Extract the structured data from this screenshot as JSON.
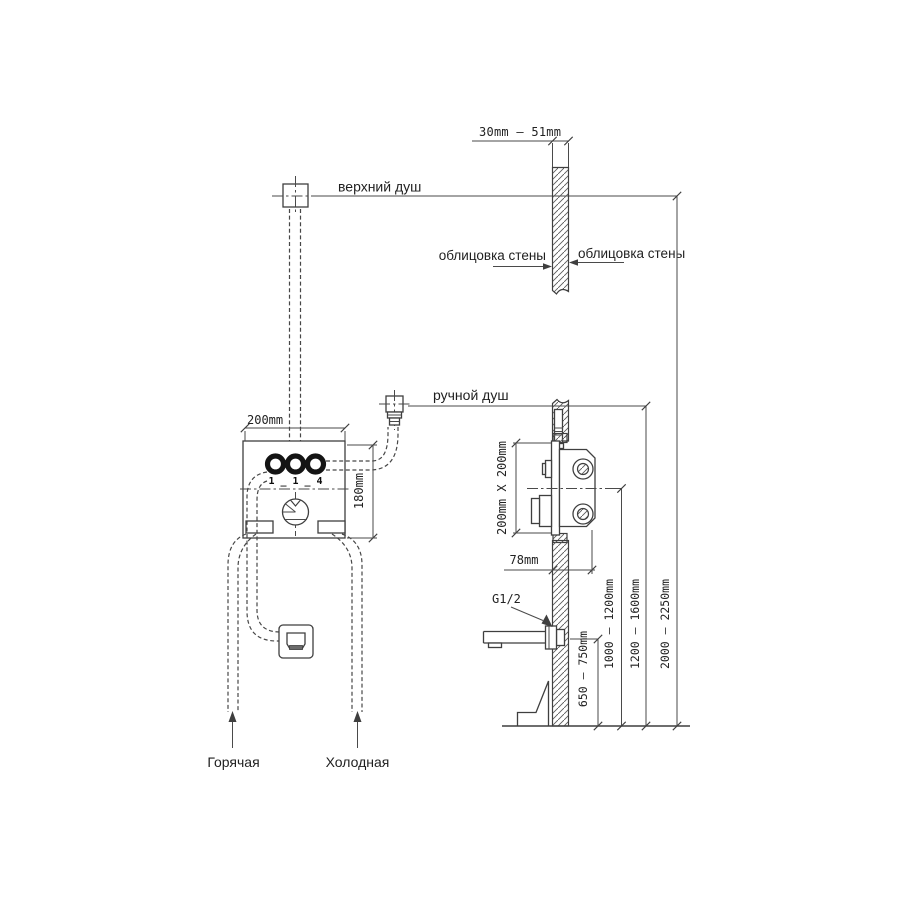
{
  "labels": {
    "top_thickness": "30mm – 51mm",
    "upper_shower": "верхний душ",
    "cladding_left": "облицовка стены",
    "cladding_right": "облицовка стены",
    "hand_shower": "ручной душ",
    "box_width": "200mm",
    "box_height": "180mm",
    "side_box_size": "200mm X 200mm",
    "box_depth": "78mm",
    "thread": "G1/2",
    "port_markings": "1_1_4",
    "height_spout": "650 — 750mm",
    "height_mixer": "1000 — 1200mm",
    "height_hand_shower": "1200 — 1600mm",
    "height_head_shower": "2000 — 2250mm",
    "hot": "Горячая",
    "cold": "Холодная"
  },
  "colors": {
    "ink": "#3f3f3f",
    "background": "#ffffff"
  }
}
